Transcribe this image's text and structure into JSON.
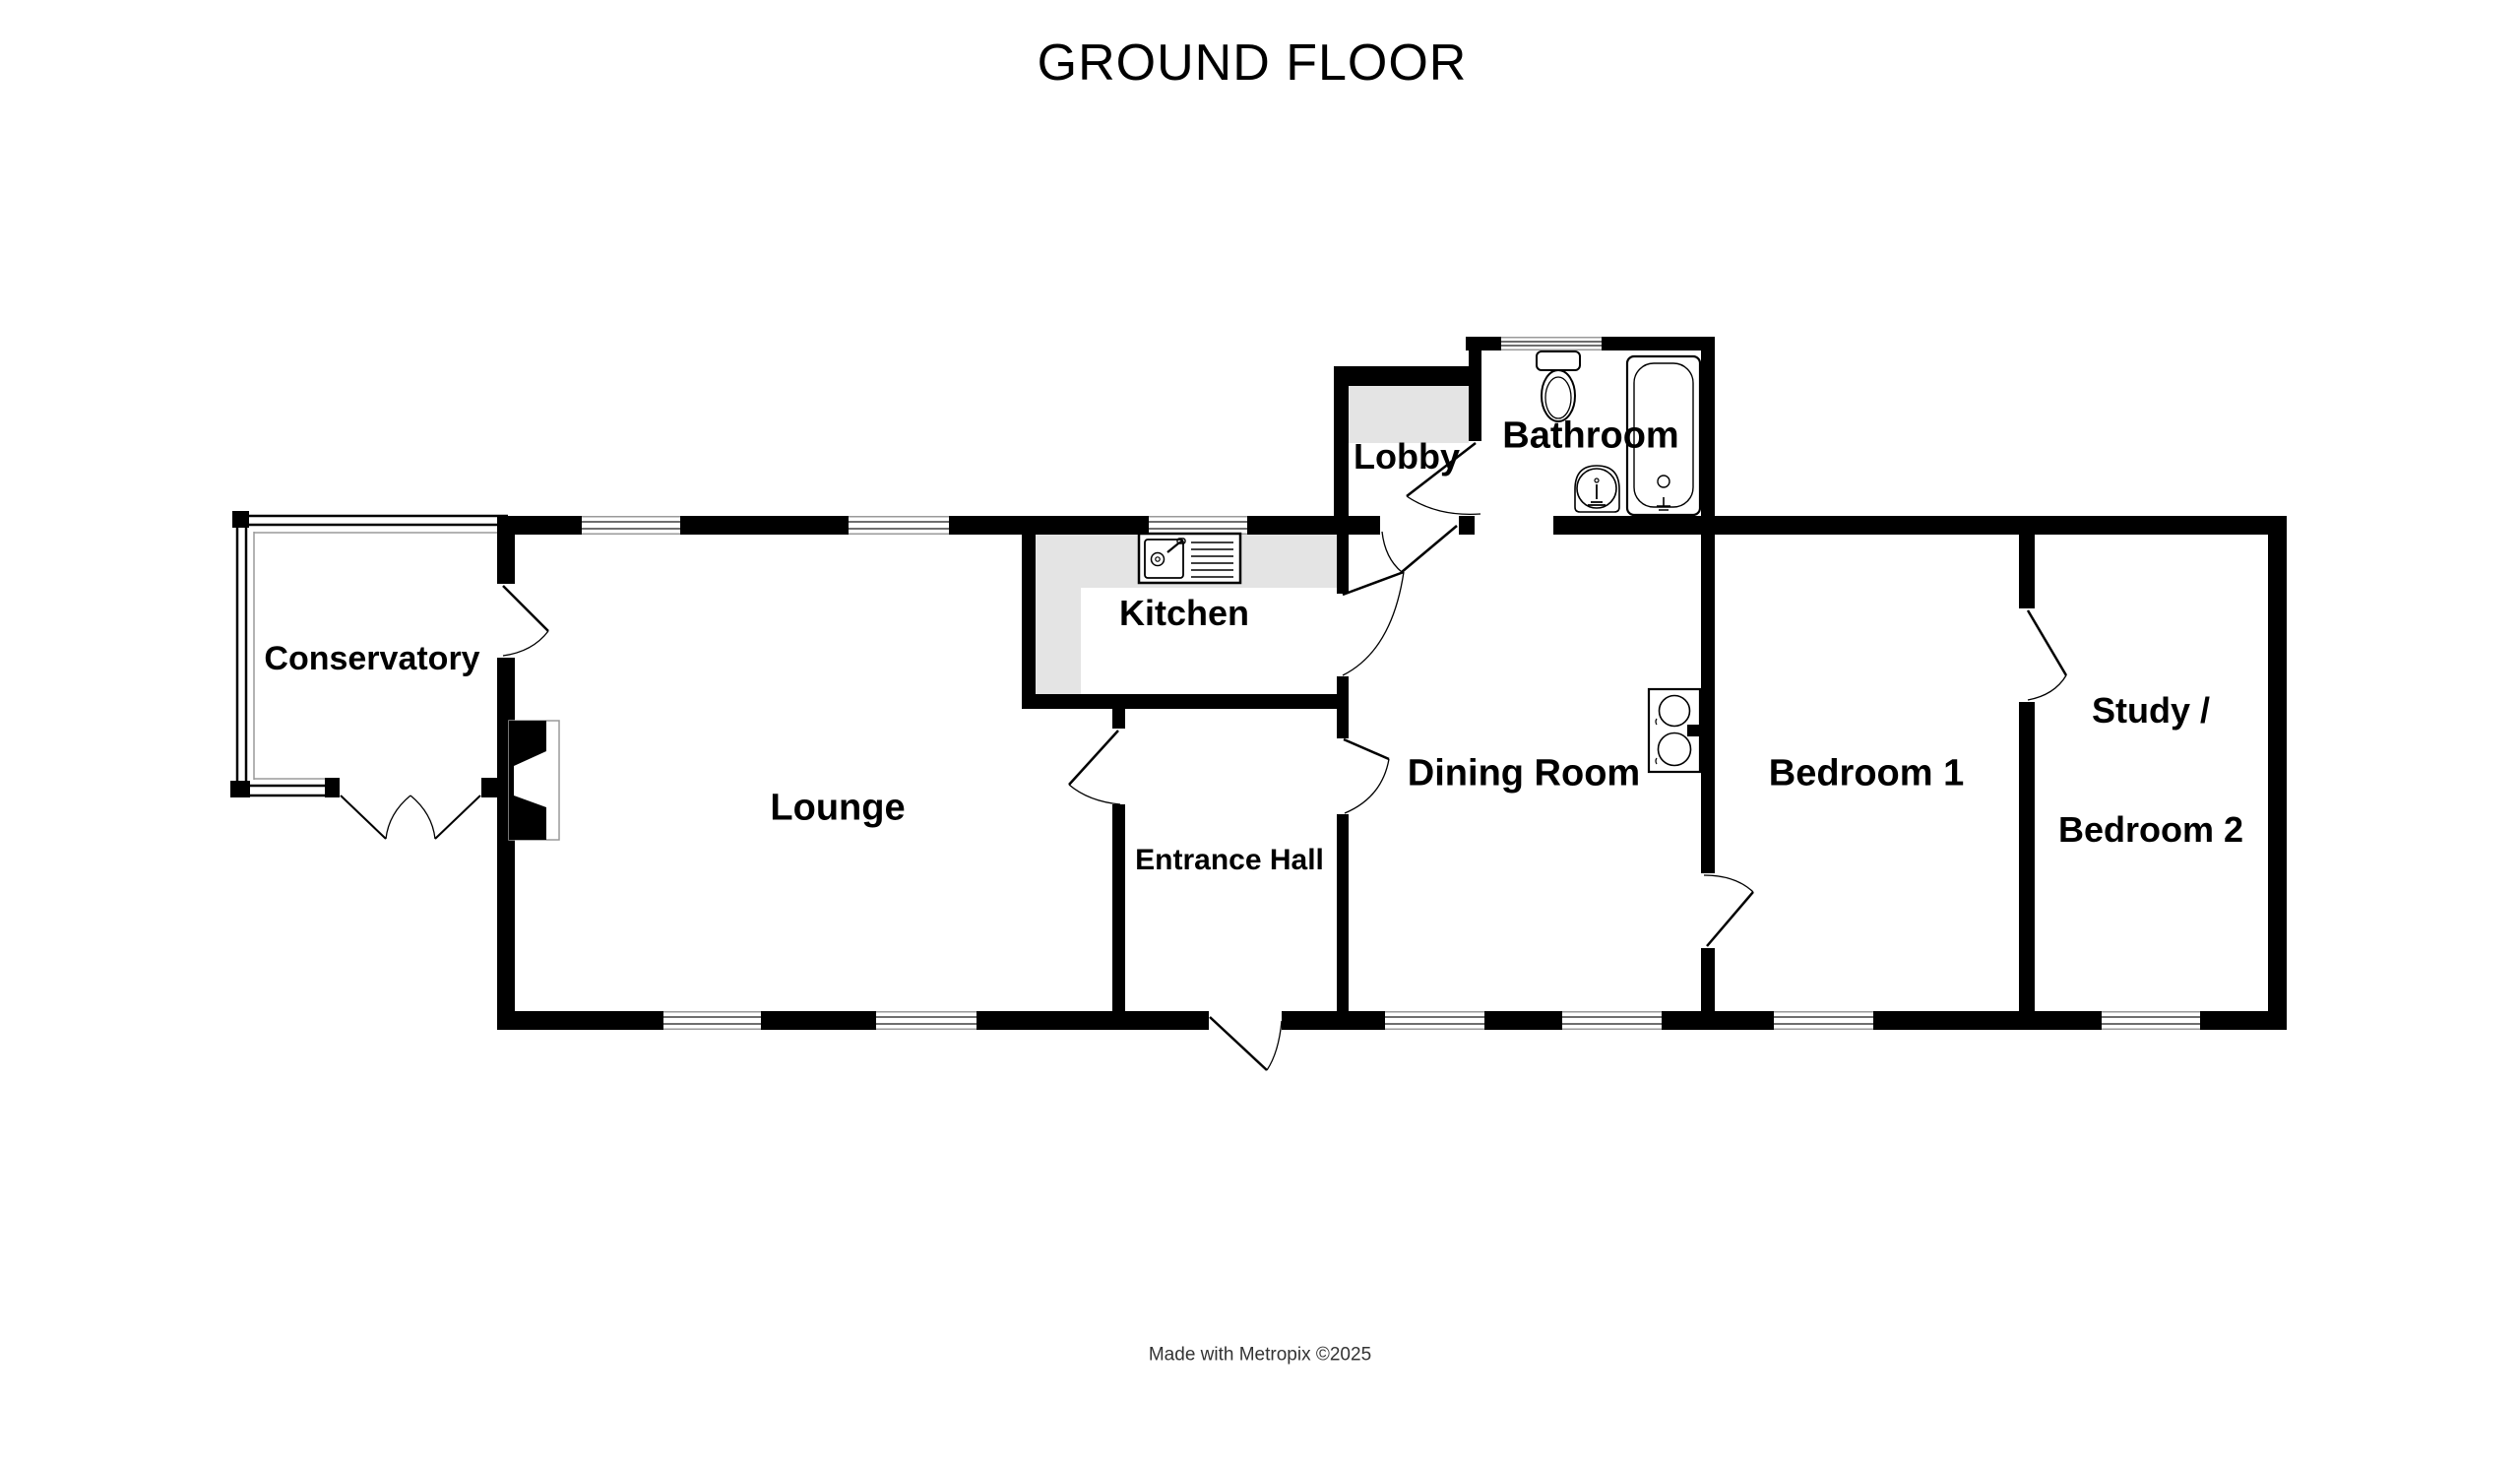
{
  "title": "GROUND FLOOR",
  "footer": "Made with Metropix ©2025",
  "rooms": {
    "conservatory": "Conservatory",
    "lounge": "Lounge",
    "kitchen": "Kitchen",
    "entrance_hall": "Entrance Hall",
    "dining_room": "Dining Room",
    "lobby": "Lobby",
    "bathroom": "Bathroom",
    "bedroom_1": "Bedroom 1",
    "study_line1": "Study /",
    "study_line2": "Bedroom 2"
  },
  "fixtures": [
    "kitchen-sink-icon",
    "toilet-icon",
    "bathtub-icon",
    "wash-basin-icon",
    "hob-icon",
    "fireplace-icon"
  ],
  "features": {
    "doors": [
      "conservatory-french-doors",
      "conservatory-to-lounge",
      "lounge-to-hall",
      "hall-to-dining",
      "front-door",
      "kitchen-to-dining",
      "lobby-to-dining",
      "lobby-to-bathroom",
      "dining-to-bedroom-1",
      "bedroom-1-to-study"
    ],
    "window_count": 10
  },
  "colors": {
    "wall": "#000000",
    "floor_shading": "#e4e4e4",
    "window_line": "#6e6e6e",
    "footer_text": "#333333",
    "background": "#ffffff"
  }
}
